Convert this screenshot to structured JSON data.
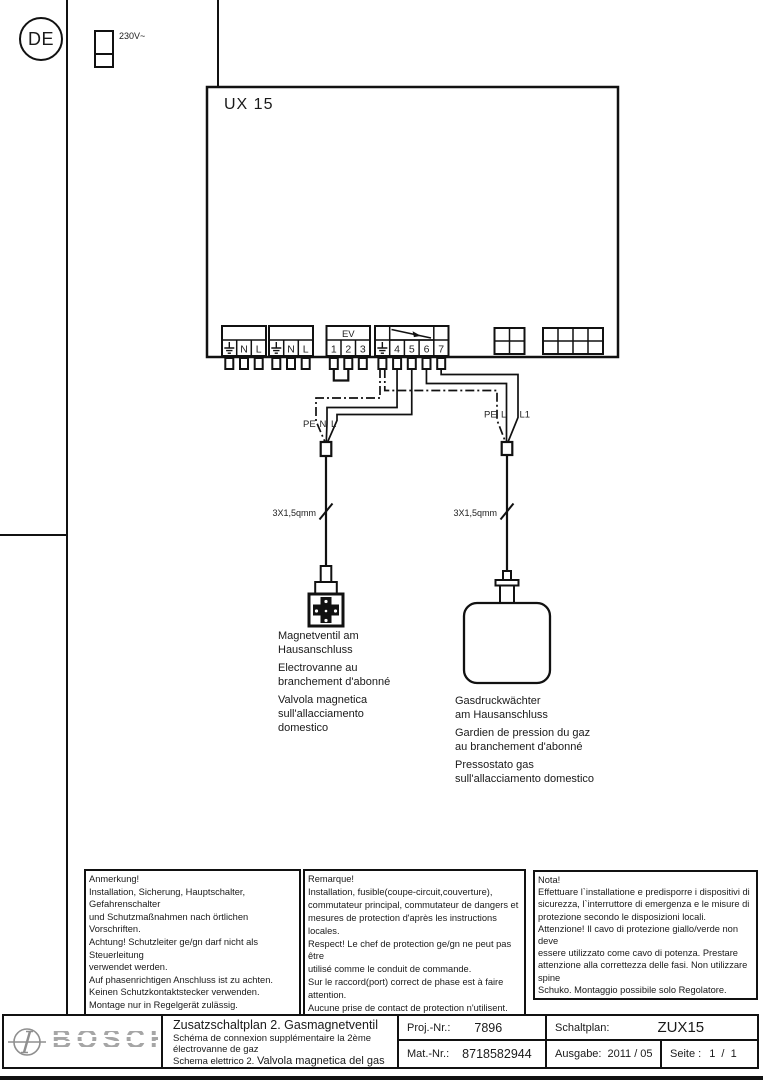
{
  "header": {
    "country": "DE",
    "voltage": "230V~"
  },
  "device": {
    "name": "UX 15"
  },
  "terminals": {
    "ev_title": "EV",
    "block1": [
      "N",
      "L"
    ],
    "block2": [
      "N",
      "L"
    ],
    "block3": [
      "1",
      "2",
      "3"
    ],
    "block4": [
      "4",
      "5",
      "6",
      "7"
    ]
  },
  "connectors": {
    "left_labels": [
      "PE",
      "N",
      "L"
    ],
    "right_labels": [
      "PE",
      "L",
      "L1"
    ],
    "left_cable": "3X1,5qmm",
    "right_cable": "3X1,5qmm"
  },
  "captions": {
    "valve_de": [
      "Magnetventil am",
      "Hausanschluss"
    ],
    "valve_fr": [
      "Electrovanne au",
      "branchement d'abonné"
    ],
    "valve_it": [
      "Valvola magnetica",
      "sull'allacciamento",
      "domestico"
    ],
    "pressure_de": [
      "Gasdruckwächter",
      "am Hausanschluss"
    ],
    "pressure_fr": [
      "Gardien de pression du gaz",
      "au branchement d'abonné"
    ],
    "pressure_it": [
      "Pressostato gas",
      "sull'allacciamento domestico"
    ]
  },
  "notes": {
    "de": [
      "Anmerkung!",
      "Installation, Sicherung, Hauptschalter, Gefahrenschalter",
      "und Schutzmaßnahmen nach örtlichen Vorschriften.",
      "Achtung! Schutzleiter ge/gn darf nicht als Steuerleitung",
      "verwendet werden.",
      "Auf phasenrichtigen Anschluss ist zu achten.",
      "Keinen Schutzkontaktstecker verwenden.",
      "Montage nur in Regelgerät zulässig."
    ],
    "fr": [
      "Remarque!",
      "Installation, fusible(coupe-circuit,couverture),",
      "commutateur principal, commutateur de dangers et",
      "mesures de protection d'après les instructions locales.",
      "Respect! Le chef de protection ge/gn ne peut pas être",
      "utilisé comme le conduit de commande.",
      "Sur le raccord(port) correct de phase est à faire",
      "attention.",
      "Aucune prise de contact de protection n'utilisent.",
      "Montage seulement dans Régulateur admissible."
    ],
    "it": [
      "Nota!",
      "Effettuare l`installatione e predisporre i dispositivi di",
      "sicurezza, l`interruttore di emergenza e le misure di",
      "protezione secondo le disposizioni locali.",
      "Attenzione! Il cavo di protezione giallo/verde non deve",
      "essere utilizzato come cavo di potenza. Prestare",
      "attenzione alla correttezza delle fasi. Non utilizzare spine",
      "Schuko. Montaggio possibile solo Regolatore."
    ]
  },
  "title_block": {
    "brand": "BOSCH",
    "title_de": "Zusatzschaltplan 2. Gasmagnetventil",
    "title_fr_line1": "Schéma de connexion supplémentaire la 2ème",
    "title_fr_line2": "électrovanne de gaz",
    "title_it_prefix": "Schema elettrico 2.",
    "title_it_main": "Valvola magnetica del gas",
    "proj_label": "Proj.-Nr.:",
    "proj_value": "7896",
    "mat_label": "Mat.-Nr.:",
    "mat_value": "8718582944",
    "plan_label": "Schaltplan:",
    "plan_value": "ZUX15",
    "issue_label": "Ausgabe:",
    "issue_value": "2011 / 05",
    "sheet_label": "Seite :",
    "sheet_value": "1  /  1"
  }
}
